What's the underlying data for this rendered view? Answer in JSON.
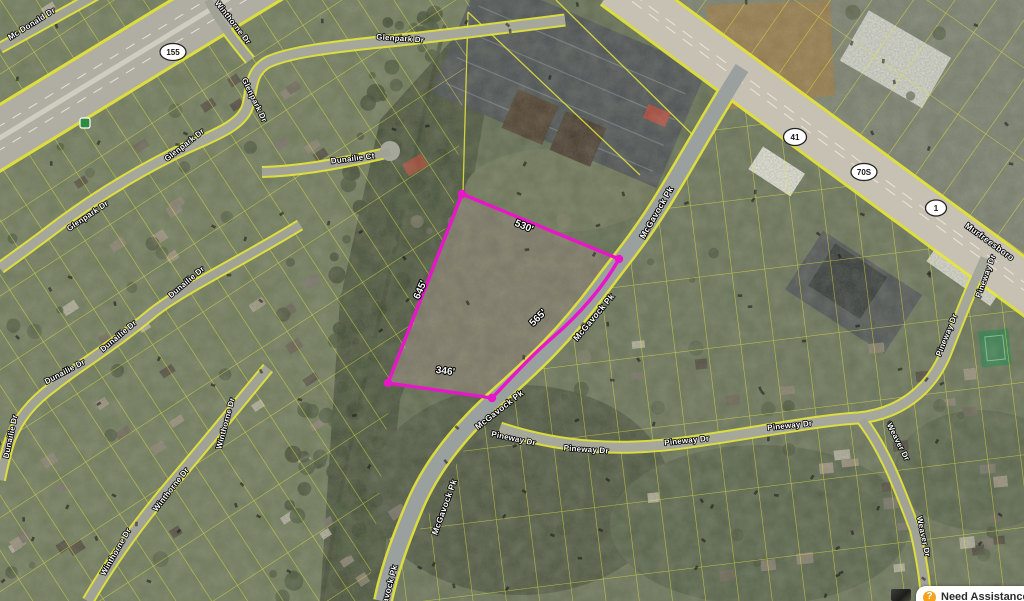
{
  "map": {
    "parcel": {
      "outline_color": "#e816c8",
      "dimensions": [
        {
          "text": "530'"
        },
        {
          "text": "645'"
        },
        {
          "text": "346'"
        },
        {
          "text": "565'"
        }
      ]
    },
    "parcel_line_color": "#e8e83a",
    "street_labels": [
      {
        "text": "Mc Donald Dr"
      },
      {
        "text": "Winthorne Dr"
      },
      {
        "text": "Glenpark Dr"
      },
      {
        "text": "Glenpark Dr"
      },
      {
        "text": "Glenpark Dr"
      },
      {
        "text": "Glenpark Dr"
      },
      {
        "text": "Dunailie Ct"
      },
      {
        "text": "Dunailie Dr"
      },
      {
        "text": "Dunailie Dr"
      },
      {
        "text": "Dunailie Dr"
      },
      {
        "text": "Dunailie Dr"
      },
      {
        "text": "Winthorne Dr"
      },
      {
        "text": "Winthorne Dr"
      },
      {
        "text": "Winthorne Dr"
      },
      {
        "text": "McGavock Pk"
      },
      {
        "text": "McGavock Pk"
      },
      {
        "text": "McGavock Pk"
      },
      {
        "text": "McGavock Pk"
      },
      {
        "text": "McGavock Pk"
      },
      {
        "text": "Pineway Dr"
      },
      {
        "text": "Pineway Dr"
      },
      {
        "text": "Pineway Dr"
      },
      {
        "text": "Pineway Dr"
      },
      {
        "text": "Pineway Dr"
      },
      {
        "text": "Pineway Dr"
      },
      {
        "text": "Weaver Dr"
      },
      {
        "text": "Weaver Dr"
      },
      {
        "text": "Murfreesboro"
      }
    ],
    "route_shields": [
      {
        "text": "155"
      },
      {
        "text": "41"
      },
      {
        "text": "70S"
      },
      {
        "text": "1"
      }
    ]
  },
  "overlay": {
    "assistance": {
      "icon": "?",
      "label": "Need Assistance?:"
    }
  }
}
